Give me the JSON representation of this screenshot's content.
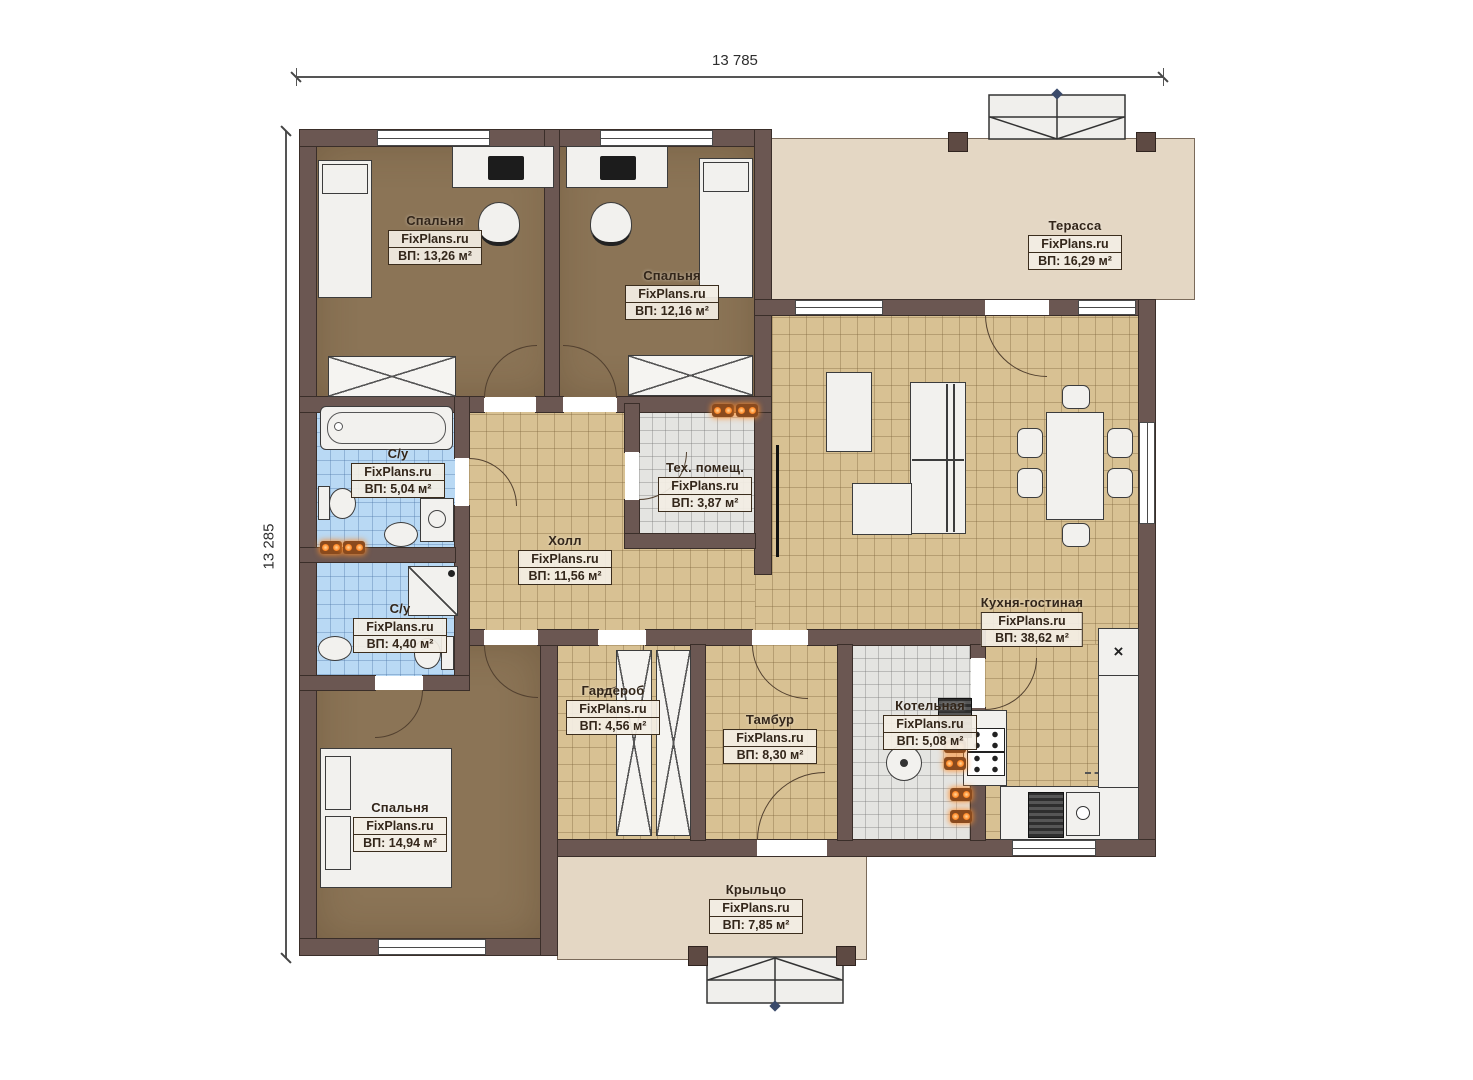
{
  "dimensions": {
    "width_label": "13 785",
    "height_label": "13 285"
  },
  "rooms": {
    "bedroom1": {
      "name": "Спальня",
      "watermark": "FixPlans.ru",
      "area": "ВП: 13,26 м²"
    },
    "bedroom2": {
      "name": "Спальня",
      "watermark": "FixPlans.ru",
      "area": "ВП: 12,16 м²"
    },
    "terrace": {
      "name": "Терасса",
      "watermark": "FixPlans.ru",
      "area": "ВП: 16,29 м²"
    },
    "bath1": {
      "name": "С/у",
      "watermark": "FixPlans.ru",
      "area": "ВП: 5,04 м²"
    },
    "tech": {
      "name": "Тех. помещ.",
      "watermark": "FixPlans.ru",
      "area": "ВП: 3,87 м²"
    },
    "hall": {
      "name": "Холл",
      "watermark": "FixPlans.ru",
      "area": "ВП: 11,56 м²"
    },
    "kitchen": {
      "name": "Кухня-гостиная",
      "watermark": "FixPlans.ru",
      "area": "ВП: 38,62 м²"
    },
    "bath2": {
      "name": "С/у",
      "watermark": "FixPlans.ru",
      "area": "ВП: 4,40 м²"
    },
    "wardrobe": {
      "name": "Гардероб",
      "watermark": "FixPlans.ru",
      "area": "ВП: 4,56 м²"
    },
    "tambour": {
      "name": "Тамбур",
      "watermark": "FixPlans.ru",
      "area": "ВП: 8,30 м²"
    },
    "boiler": {
      "name": "Котельная",
      "watermark": "FixPlans.ru",
      "area": "ВП: 5,08 м²"
    },
    "bedroom3": {
      "name": "Спальня",
      "watermark": "FixPlans.ru",
      "area": "ВП: 14,94 м²"
    },
    "porch": {
      "name": "Крыльцо",
      "watermark": "FixPlans.ru",
      "area": "ВП: 7,85 м²"
    }
  },
  "icons": {
    "fridge_mark": "×"
  },
  "colors": {
    "wall": "#6b5752",
    "tile_tan": "#d8c193",
    "tile_blue": "#b9d9f4",
    "tile_gray": "#e4e4e1",
    "floor_brown": "#8b7456",
    "terrace_beige": "#e4d7c4",
    "heater_orange": "#ff8a2a"
  }
}
